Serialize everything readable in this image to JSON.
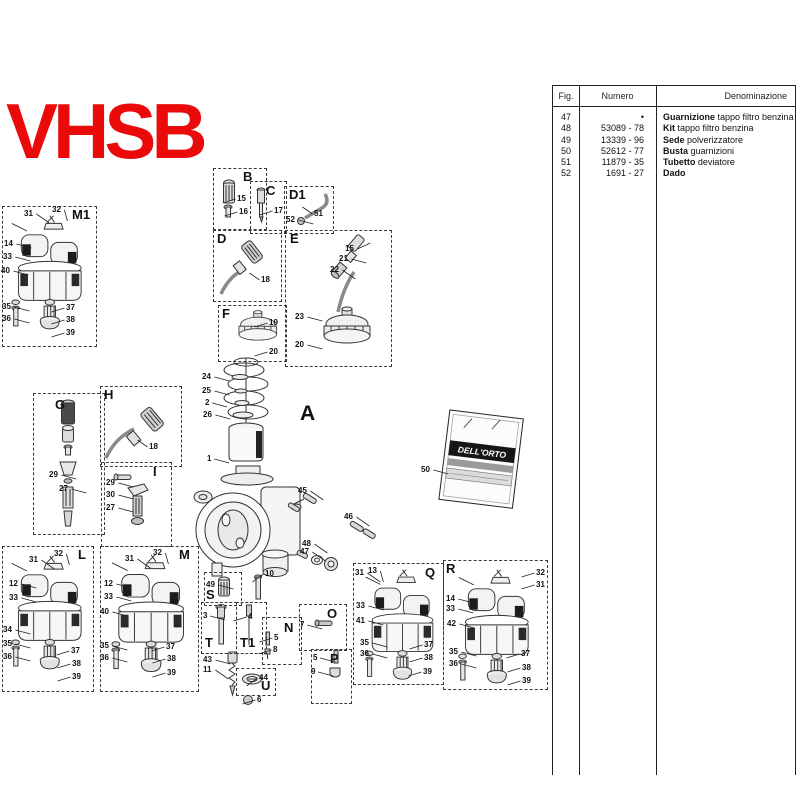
{
  "title": "VHSB",
  "section_label_a": "A",
  "packet_label": "DELL'ORTO",
  "colors": {
    "title_red": "#ea0a0a"
  },
  "table": {
    "headers": {
      "fig": "Fig.",
      "numero": "Numero",
      "denominazione": "Denominazione"
    },
    "rows": [
      {
        "fig": "47",
        "numero": "•",
        "bold": "Guarnizione",
        "rest": "tappo filtro benzina"
      },
      {
        "fig": "48",
        "numero": "53089 - 78",
        "bold": "Kit",
        "rest": "tappo filtro benzina"
      },
      {
        "fig": "49",
        "numero": "13339 - 96",
        "bold": "Sede",
        "rest": "polverizzatore"
      },
      {
        "fig": "50",
        "numero": "52612 - 77",
        "bold": "Busta",
        "rest": "guarnizioni"
      },
      {
        "fig": "51",
        "numero": "11879 - 35",
        "bold": "Tubetto",
        "rest": "deviatore"
      },
      {
        "fig": "52",
        "numero": "1691 - 27",
        "bold": "Dado",
        "rest": ""
      }
    ]
  },
  "diagram": {
    "boxes": [
      {
        "label": "M1",
        "x": 2,
        "y": 206,
        "w": 93,
        "h": 139,
        "lx": 72,
        "ly": 208
      },
      {
        "label": "B",
        "x": 213,
        "y": 168,
        "w": 52,
        "h": 60,
        "lx": 243,
        "ly": 170
      },
      {
        "label": "C",
        "x": 250,
        "y": 181,
        "w": 35,
        "h": 51,
        "lx": 266,
        "ly": 184
      },
      {
        "label": "D1",
        "x": 284,
        "y": 186,
        "w": 48,
        "h": 46,
        "lx": 289,
        "ly": 188
      },
      {
        "label": "D",
        "x": 213,
        "y": 230,
        "w": 67,
        "h": 70,
        "lx": 217,
        "ly": 232
      },
      {
        "label": "E",
        "x": 285,
        "y": 230,
        "w": 105,
        "h": 135,
        "lx": 290,
        "ly": 232
      },
      {
        "label": "F",
        "x": 218,
        "y": 305,
        "w": 67,
        "h": 55,
        "lx": 222,
        "ly": 307
      },
      {
        "label": "G",
        "x": 33,
        "y": 393,
        "w": 70,
        "h": 140,
        "lx": 55,
        "ly": 398
      },
      {
        "label": "H",
        "x": 100,
        "y": 386,
        "w": 80,
        "h": 79,
        "lx": 104,
        "ly": 388
      },
      {
        "label": "I",
        "x": 101,
        "y": 462,
        "w": 69,
        "h": 83,
        "lx": 153,
        "ly": 465
      },
      {
        "label": "L",
        "x": 2,
        "y": 546,
        "w": 90,
        "h": 144,
        "lx": 78,
        "ly": 548
      },
      {
        "label": "M",
        "x": 100,
        "y": 546,
        "w": 97,
        "h": 144,
        "lx": 179,
        "ly": 548
      },
      {
        "label": "S",
        "x": 204,
        "y": 572,
        "w": 36,
        "h": 32,
        "lx": 206,
        "ly": 588
      },
      {
        "label": "T",
        "x": 201,
        "y": 602,
        "w": 34,
        "h": 50,
        "lx": 205,
        "ly": 636
      },
      {
        "label": "T1",
        "x": 236,
        "y": 602,
        "w": 29,
        "h": 50,
        "lx": 240,
        "ly": 636
      },
      {
        "label": "N",
        "x": 262,
        "y": 617,
        "w": 38,
        "h": 46,
        "lx": 284,
        "ly": 621
      },
      {
        "label": "O",
        "x": 299,
        "y": 604,
        "w": 46,
        "h": 45,
        "lx": 327,
        "ly": 607
      },
      {
        "label": "P",
        "x": 311,
        "y": 649,
        "w": 39,
        "h": 53,
        "lx": 330,
        "ly": 652
      },
      {
        "label": "U",
        "x": 236,
        "y": 668,
        "w": 38,
        "h": 26,
        "lx": 261,
        "ly": 679
      },
      {
        "label": "Q",
        "x": 353,
        "y": 563,
        "w": 89,
        "h": 120,
        "lx": 425,
        "ly": 566
      },
      {
        "label": "R",
        "x": 443,
        "y": 560,
        "w": 103,
        "h": 128,
        "lx": 446,
        "ly": 562
      }
    ],
    "callouts": [
      [
        "31",
        24,
        210,
        "rd"
      ],
      [
        "32",
        52,
        206,
        "d"
      ],
      [
        "14",
        4,
        240,
        "r"
      ],
      [
        "33",
        3,
        253,
        "r"
      ],
      [
        "40",
        1,
        267,
        "r"
      ],
      [
        "35",
        2,
        303,
        "r"
      ],
      [
        "36",
        2,
        315,
        "r"
      ],
      [
        "37",
        66,
        304,
        "l"
      ],
      [
        "38",
        66,
        316,
        "l"
      ],
      [
        "39",
        66,
        329,
        "l"
      ],
      [
        "15",
        237,
        195,
        "l"
      ],
      [
        "16",
        239,
        208,
        "l"
      ],
      [
        "17",
        274,
        207,
        "l"
      ],
      [
        "51",
        314,
        210,
        "lu"
      ],
      [
        "52",
        286,
        216,
        "r"
      ],
      [
        "18",
        261,
        276,
        "lu"
      ],
      [
        "15",
        345,
        245,
        "ru"
      ],
      [
        "21",
        339,
        255,
        "r"
      ],
      [
        "22",
        330,
        266,
        "rd"
      ],
      [
        "23",
        295,
        313,
        "r"
      ],
      [
        "20",
        295,
        341,
        "r"
      ],
      [
        "19",
        269,
        319,
        "l"
      ],
      [
        "20",
        269,
        348,
        "l"
      ],
      [
        "24",
        202,
        373,
        "r"
      ],
      [
        "25",
        202,
        387,
        "r"
      ],
      [
        "2",
        205,
        399,
        "r"
      ],
      [
        "26",
        203,
        411,
        "r"
      ],
      [
        "1",
        207,
        455,
        "r"
      ],
      [
        "29",
        49,
        471,
        "r"
      ],
      [
        "27",
        59,
        485,
        "r"
      ],
      [
        "18",
        149,
        443,
        "lu"
      ],
      [
        "29",
        106,
        479,
        "r"
      ],
      [
        "30",
        106,
        491,
        "r"
      ],
      [
        "27",
        106,
        504,
        "r"
      ],
      [
        "31",
        29,
        556,
        "rd"
      ],
      [
        "32",
        54,
        550,
        "d"
      ],
      [
        "12",
        9,
        580,
        "r"
      ],
      [
        "33",
        9,
        594,
        "r"
      ],
      [
        "34",
        3,
        626,
        "r"
      ],
      [
        "35",
        3,
        640,
        "r"
      ],
      [
        "36",
        3,
        653,
        "r"
      ],
      [
        "37",
        71,
        647,
        "l"
      ],
      [
        "38",
        72,
        660,
        "l"
      ],
      [
        "39",
        72,
        673,
        "l"
      ],
      [
        "31",
        125,
        555,
        "rd"
      ],
      [
        "32",
        153,
        549,
        "d"
      ],
      [
        "12",
        104,
        580,
        "r"
      ],
      [
        "33",
        104,
        593,
        "r"
      ],
      [
        "40",
        100,
        608,
        "r"
      ],
      [
        "35",
        100,
        642,
        "r"
      ],
      [
        "36",
        100,
        654,
        "r"
      ],
      [
        "37",
        166,
        643,
        "l"
      ],
      [
        "38",
        167,
        655,
        "l"
      ],
      [
        "39",
        167,
        669,
        "l"
      ],
      [
        "10",
        265,
        570,
        "ld"
      ],
      [
        "45",
        298,
        487,
        "rd"
      ],
      [
        "46",
        344,
        513,
        "rd"
      ],
      [
        "48",
        302,
        540,
        "rd"
      ],
      [
        "47",
        300,
        548,
        "rd"
      ],
      [
        "49",
        206,
        581,
        "r"
      ],
      [
        "3",
        203,
        612,
        "r"
      ],
      [
        "4",
        248,
        613,
        "l"
      ],
      [
        "5",
        274,
        634,
        "l"
      ],
      [
        "8",
        273,
        646,
        "l"
      ],
      [
        "7",
        300,
        621,
        "r"
      ],
      [
        "5",
        313,
        654,
        "r"
      ],
      [
        "9",
        311,
        668,
        "r"
      ],
      [
        "43",
        203,
        656,
        "r"
      ],
      [
        "11",
        203,
        666,
        "rd"
      ],
      [
        "44",
        259,
        674,
        "ld"
      ],
      [
        "6",
        257,
        696,
        "l"
      ],
      [
        "50",
        421,
        466,
        "r"
      ],
      [
        "31",
        355,
        569,
        "rd"
      ],
      [
        "13",
        368,
        567,
        "d"
      ],
      [
        "33",
        356,
        602,
        "r"
      ],
      [
        "41",
        356,
        617,
        "r"
      ],
      [
        "35",
        360,
        639,
        "r"
      ],
      [
        "36",
        360,
        650,
        "r"
      ],
      [
        "37",
        424,
        641,
        "l"
      ],
      [
        "38",
        424,
        654,
        "l"
      ],
      [
        "39",
        423,
        668,
        "l"
      ],
      [
        "32",
        536,
        569,
        "l"
      ],
      [
        "31",
        536,
        581,
        "l"
      ],
      [
        "14",
        446,
        595,
        "r"
      ],
      [
        "33",
        446,
        605,
        "r"
      ],
      [
        "42",
        447,
        620,
        "r"
      ],
      [
        "35",
        449,
        648,
        "r"
      ],
      [
        "36",
        449,
        660,
        "r"
      ],
      [
        "37",
        521,
        650,
        "l"
      ],
      [
        "38",
        522,
        664,
        "l"
      ],
      [
        "39",
        522,
        677,
        "l"
      ]
    ]
  }
}
